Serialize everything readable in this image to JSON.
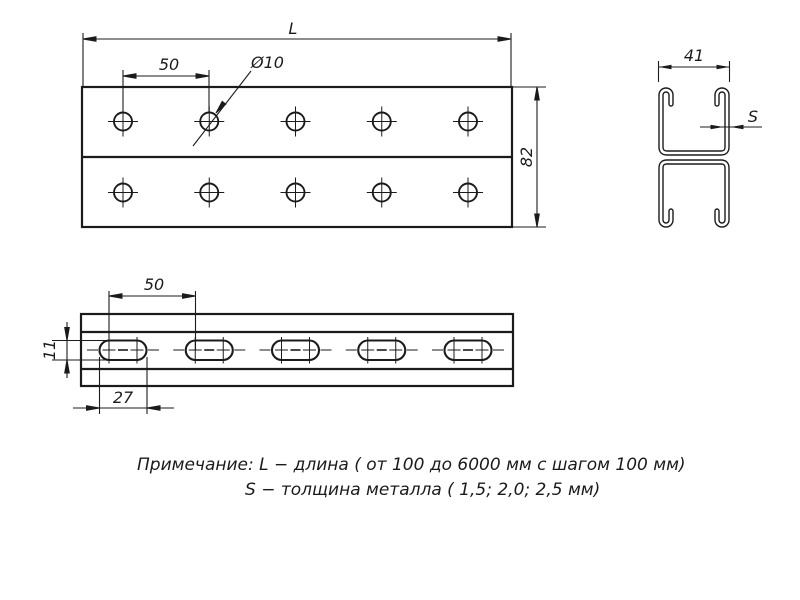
{
  "drawing": {
    "background": "#ffffff",
    "line_color": "#1b1b1b",
    "views": {
      "top_view": {
        "labels": {
          "length": "L",
          "hole_pitch": "50",
          "hole_diameter": "Ø10",
          "profile_height": "82"
        }
      },
      "section_view": {
        "labels": {
          "width": "41",
          "thickness": "S"
        }
      },
      "side_view": {
        "labels": {
          "slot_pitch": "50",
          "slot_height": "11",
          "slot_length": "27"
        }
      }
    },
    "note": {
      "line1": "Примечание: L − длина ( от 100 до 6000 мм с шагом 100 мм)",
      "line2": "S − толщина металла ( 1,5; 2,0; 2,5 мм)"
    }
  }
}
